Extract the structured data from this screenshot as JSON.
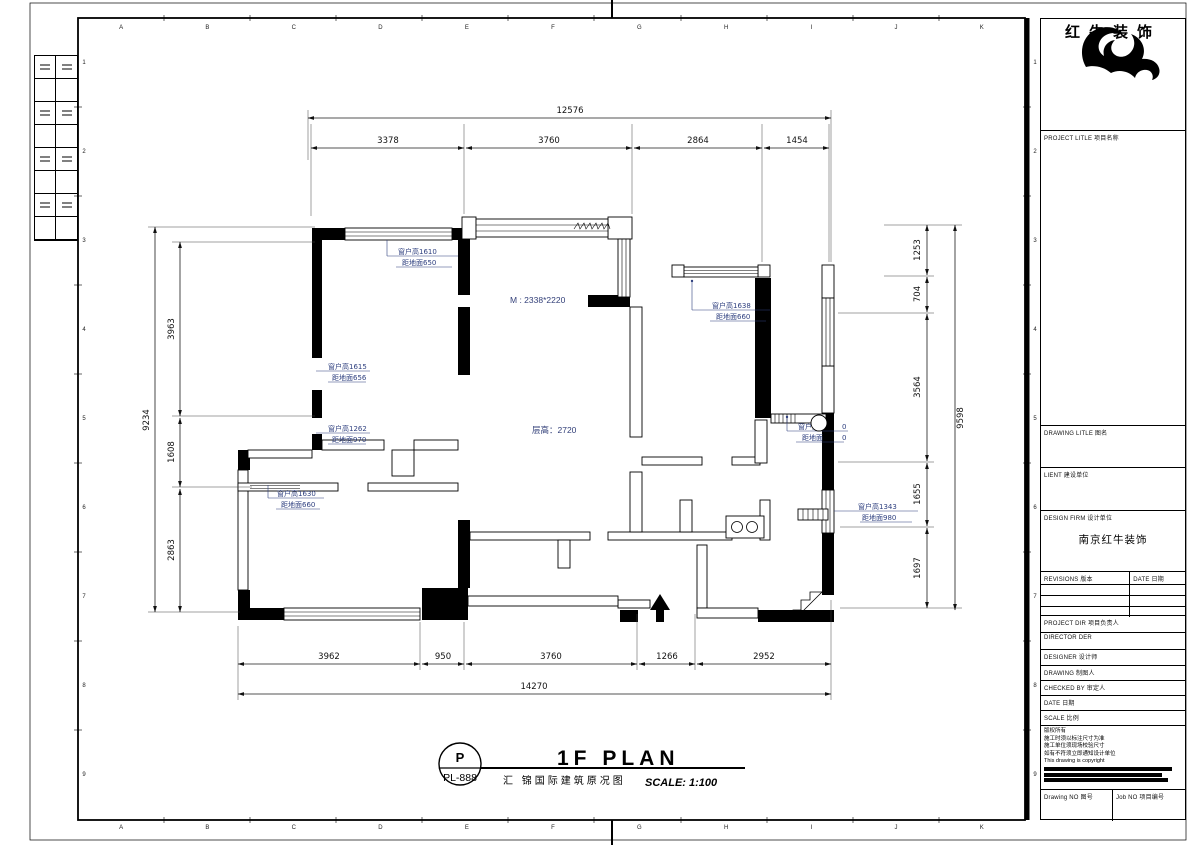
{
  "sheet": {
    "grid_letters": [
      "A",
      "B",
      "C",
      "D",
      "E",
      "F",
      "G",
      "H",
      "I",
      "J",
      "K"
    ],
    "grid_numbers": [
      "1",
      "2",
      "3",
      "4",
      "5",
      "6",
      "7",
      "8",
      "9"
    ]
  },
  "plan": {
    "room_labels": {
      "door_size": "M : 2338*2220",
      "ceiling_height": "层高：2720"
    },
    "dims": {
      "top_total": "12576",
      "top_segments": [
        "3378",
        "3760",
        "2864",
        "1454"
      ],
      "bottom_segments": [
        "3962",
        "950",
        "3760",
        "1266",
        "2952"
      ],
      "bottom_total": "14270",
      "left_total": "9234",
      "left_segments": [
        "3963",
        "1608",
        "2863"
      ],
      "right_total": "9598",
      "right_segments": [
        "1253",
        "704",
        "3564",
        "1655",
        "1697"
      ]
    },
    "window_notes": [
      {
        "h": "窗户高1610",
        "g": "距地面650"
      },
      {
        "h": "窗户高1615",
        "g": "距地面656"
      },
      {
        "h": "窗户高1262",
        "g": "距地面970"
      },
      {
        "h": "窗户高1630",
        "g": "距地面660"
      },
      {
        "h": "窗户高1638",
        "g": "距地面660"
      },
      {
        "h": "窗户高",
        "h2": "0",
        "g": "距地面",
        "g2": "0"
      },
      {
        "h": "窗户高1343",
        "g": "距地面980"
      }
    ]
  },
  "titlebar": {
    "bubble_top": "P",
    "bubble_bottom": "PL-888",
    "title": "1F PLAN",
    "subtitle": "汇 锦国际建筑原况图",
    "scale": "SCALE: 1:100"
  },
  "titleblock": {
    "brand": "红牛装饰",
    "project_title_label": "PROJECT LITLE 项目名称",
    "drawing_title_label": "DRAWING LITLE 图名",
    "client_label": "LIENT 建设单位",
    "design_firm_label": "DESIGN FIRM 设计单位",
    "design_firm_value": "南京红牛装饰",
    "revisions_label": "REVISIONS 版本",
    "revisions_date_label": "DATE 日期",
    "project_dir_label": "PROJECT DIR 项目负责人",
    "director_label": "DIRECTOR DER",
    "designer_label": "DESIGNER 设计师",
    "drawing_label": "DRAWING 制图人",
    "checked_label": "CHECKED BY 审定人",
    "date_label": "DATE 日期",
    "scale_label": "SCALE 比例",
    "notes": [
      "版权所有",
      "施工时须以标注尺寸为准",
      "施工单位须现场校验尺寸",
      "如有不符须立即通知设计单位",
      "This drawing is copyright"
    ],
    "drawing_no_label": "Drawing NO 图号",
    "job_no_label": "Job NO 项目编号"
  }
}
